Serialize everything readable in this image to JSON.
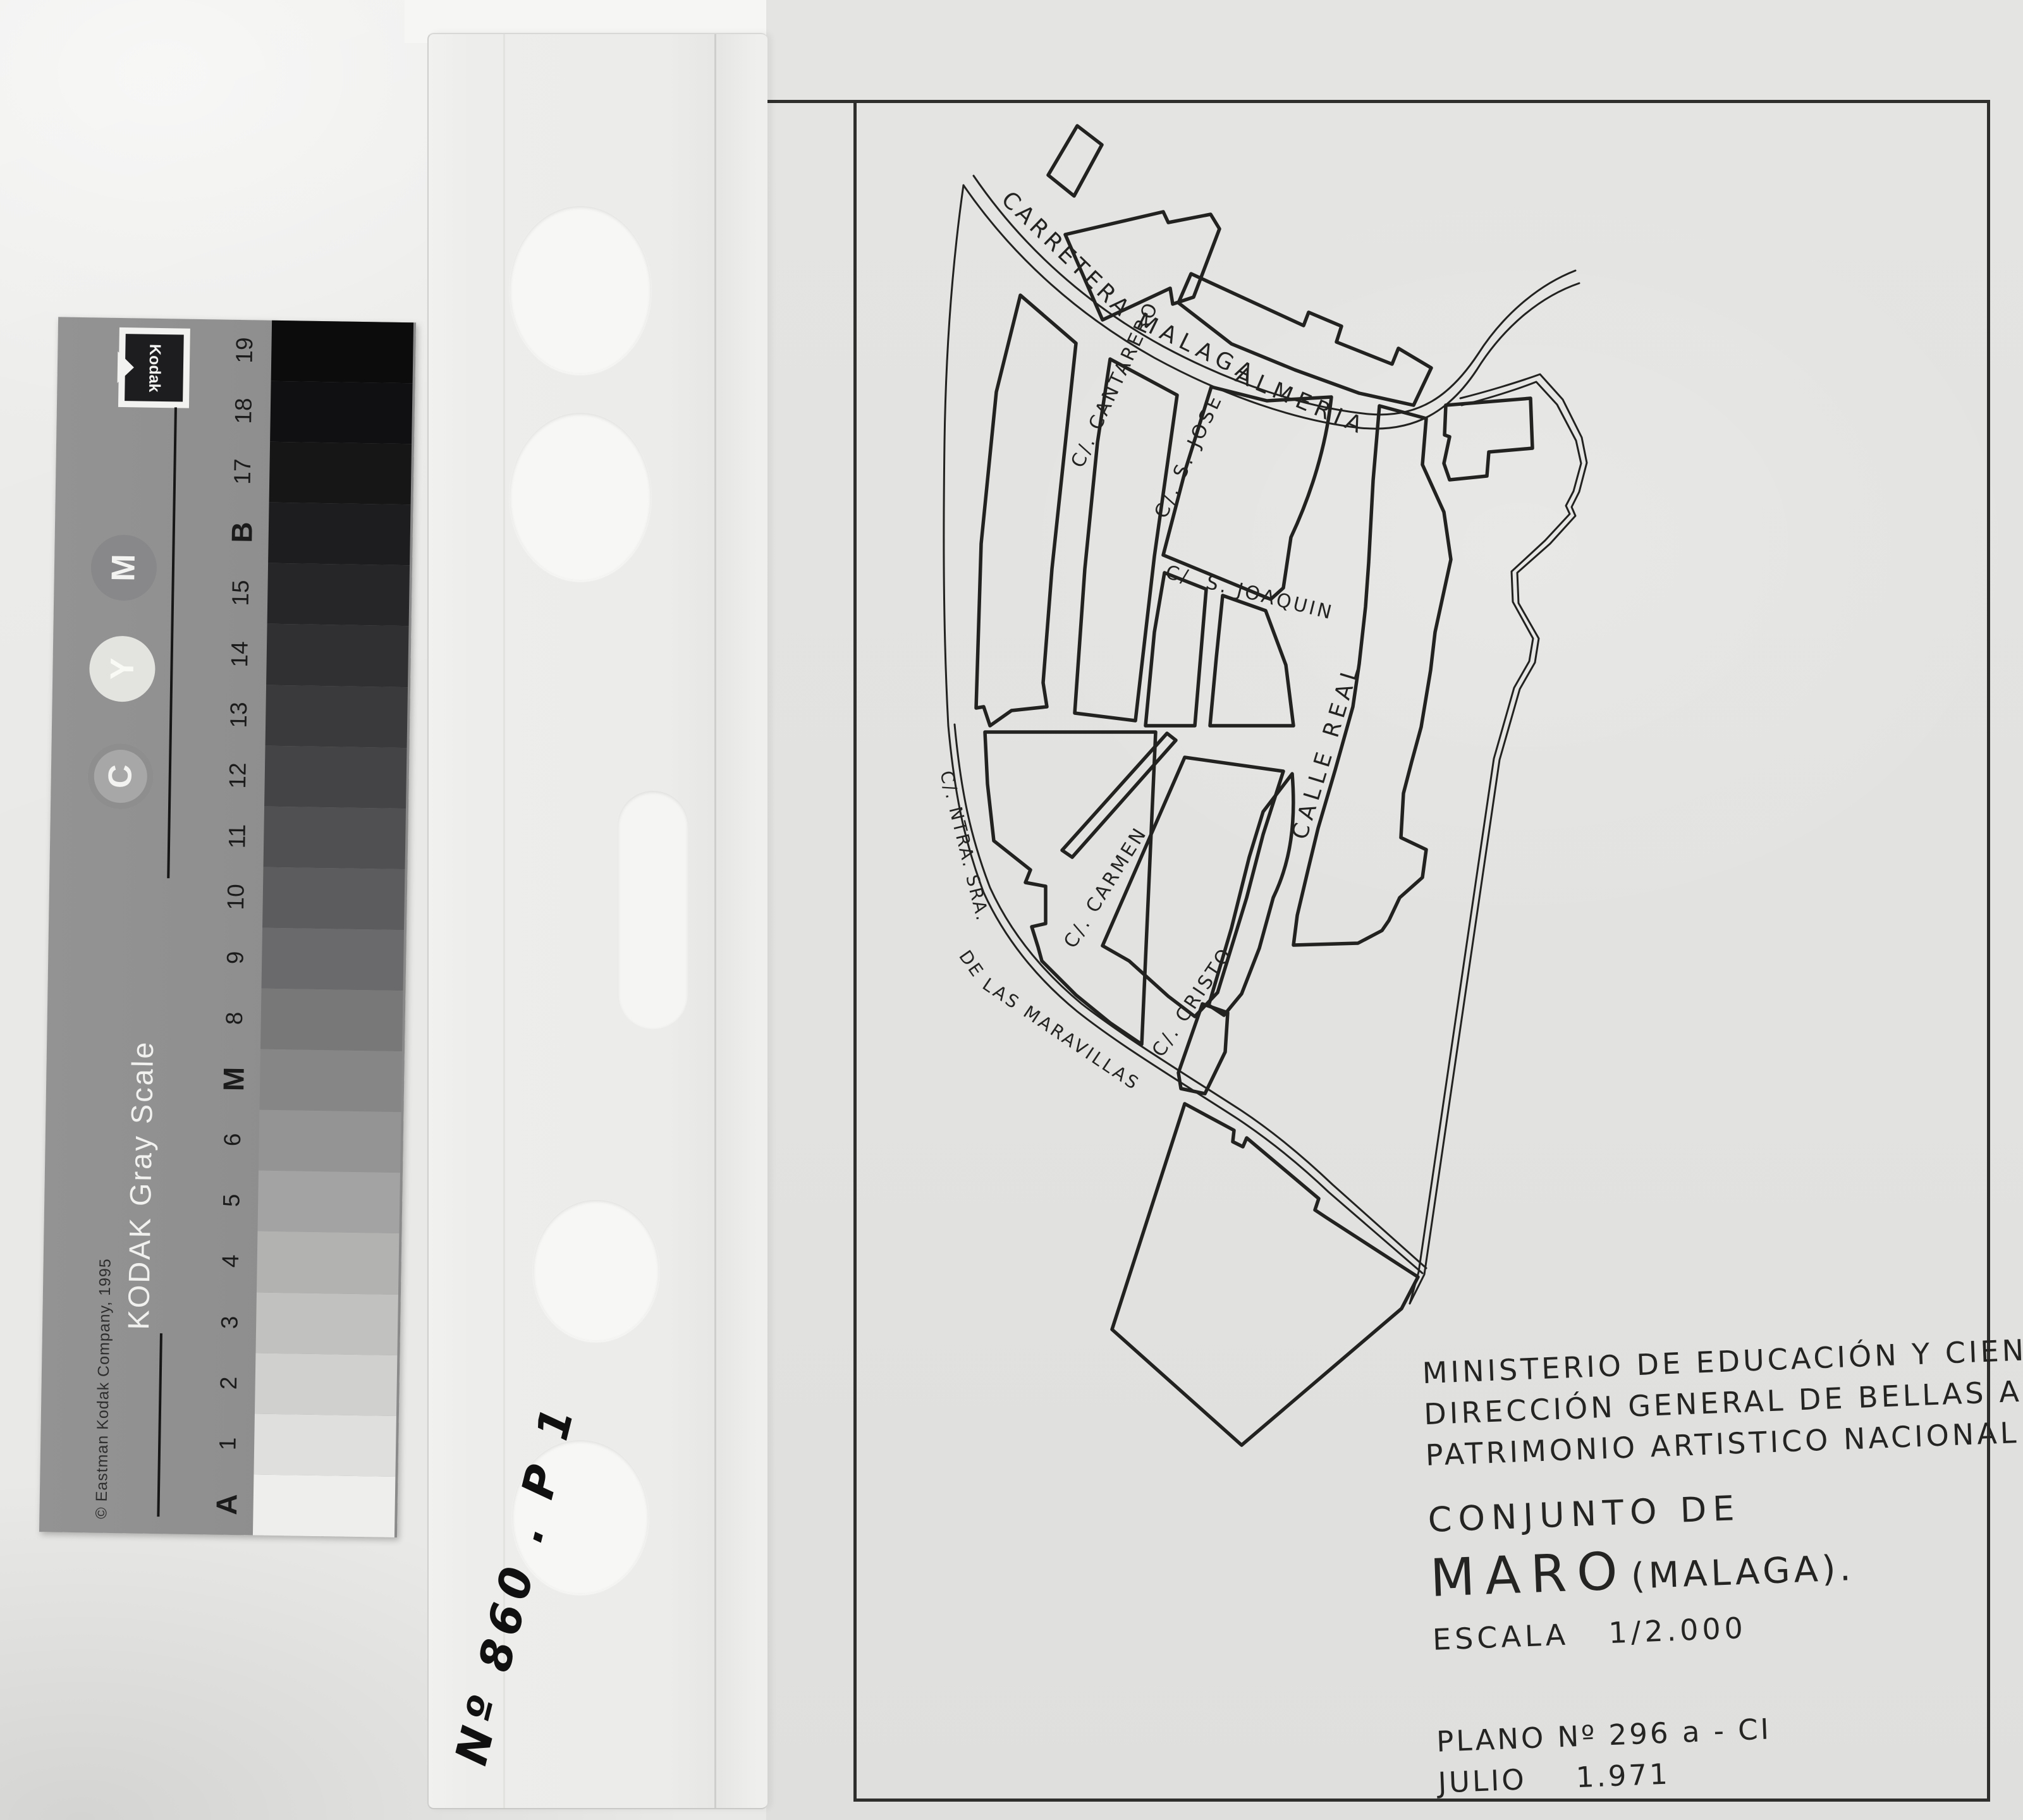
{
  "kodak_card": {
    "brand": "Kodak",
    "title": "KODAK Gray Scale",
    "copyright": "© Eastman Kodak Company, 1995",
    "ink_dots": [
      {
        "label": "M",
        "disc_color": "#88888a",
        "text_color": "#f3f3f1"
      },
      {
        "label": "Y",
        "disc_color": "#e3e3e0",
        "text_color": "#f9f9f6"
      },
      {
        "label": "C",
        "disc_color": "#a7a7a7",
        "text_color": "#f3f3f1"
      }
    ],
    "patches": [
      {
        "label": "19",
        "color": "#0c0c0d"
      },
      {
        "label": "18",
        "color": "#101012"
      },
      {
        "label": "17",
        "color": "#161617"
      },
      {
        "label": "B",
        "color": "#1d1d1f"
      },
      {
        "label": "15",
        "color": "#262628"
      },
      {
        "label": "14",
        "color": "#303032"
      },
      {
        "label": "13",
        "color": "#3a3a3c"
      },
      {
        "label": "12",
        "color": "#444446"
      },
      {
        "label": "11",
        "color": "#505052"
      },
      {
        "label": "10",
        "color": "#5c5c5e"
      },
      {
        "label": "9",
        "color": "#6a6a6c"
      },
      {
        "label": "8",
        "color": "#787879"
      },
      {
        "label": "M",
        "color": "#868687"
      },
      {
        "label": "6",
        "color": "#949495"
      },
      {
        "label": "5",
        "color": "#a3a3a3"
      },
      {
        "label": "4",
        "color": "#b2b2b1"
      },
      {
        "label": "3",
        "color": "#c1c1c0"
      },
      {
        "label": "2",
        "color": "#d0d0cf"
      },
      {
        "label": "1",
        "color": "#dfdfde"
      },
      {
        "label": "A",
        "color": "#eeeeec"
      }
    ]
  },
  "sleeve": {
    "handwritten_note": "Nº 860 . P 1"
  },
  "plan": {
    "agency_lines": [
      {
        "text": "MINISTERIO DE EDUCACIÓN Y CIENCIA"
      },
      {
        "text": "DIRECCIÓN GENERAL DE BELLAS ARTES"
      },
      {
        "text": "PATRIMONIO ARTISTICO NACIONAL"
      }
    ],
    "title_label": "CONJUNTO DE",
    "title_place": "MARO",
    "title_place_suffix": "(MALAGA).",
    "scale_label": "ESCALA",
    "scale_value": "1/2.000",
    "plano_label": "PLANO Nº 296 a - CI",
    "date_label": "JULIO",
    "date_value": "1.971",
    "streets": [
      {
        "label": "CARRETERA"
      },
      {
        "label": "MALAGA"
      },
      {
        "label": "ALMERIA"
      },
      {
        "label": "C/. CANTARERO"
      },
      {
        "label": "C/. S. JOSE"
      },
      {
        "label": "C/. S. JOAQUIN"
      },
      {
        "label": "CALLE REAL"
      },
      {
        "label": "C/. CARMEN"
      },
      {
        "label": "C/. CRISTO"
      },
      {
        "label": "C/. NTRA. SRA."
      },
      {
        "label": "DE"
      },
      {
        "label": "LAS MARAVILLAS"
      }
    ],
    "ink_color": "#222220"
  }
}
